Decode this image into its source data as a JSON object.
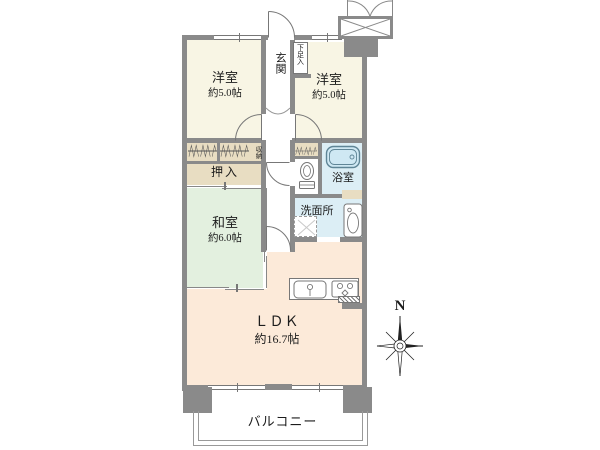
{
  "plan": {
    "entrance": {
      "label": "玄関"
    },
    "shoe_cabinet": {
      "label": "下足入"
    },
    "western_room_left": {
      "label": "洋室",
      "size": "約5.0帖"
    },
    "western_room_right": {
      "label": "洋室",
      "size": "約5.0帖"
    },
    "storage": {
      "label": "収納"
    },
    "closet": {
      "label": "押入"
    },
    "japanese_room": {
      "label": "和室",
      "size": "約6.0帖"
    },
    "bathroom": {
      "label": "浴室"
    },
    "washroom": {
      "label": "洗面所"
    },
    "ldk": {
      "label": "ＬＤＫ",
      "size": "約16.7帖"
    },
    "balcony": {
      "label": "バルコニー"
    },
    "compass": {
      "north": "N"
    }
  },
  "colors": {
    "wall": "#8a8a8a",
    "cream": "#f8f5e4",
    "green": "#e3f0df",
    "pink": "#fcead9",
    "beige": "#e8ddc2",
    "blue": "#dceef5",
    "tub": "#5f8596",
    "line": "#777777",
    "text": "#1c1c1c"
  }
}
